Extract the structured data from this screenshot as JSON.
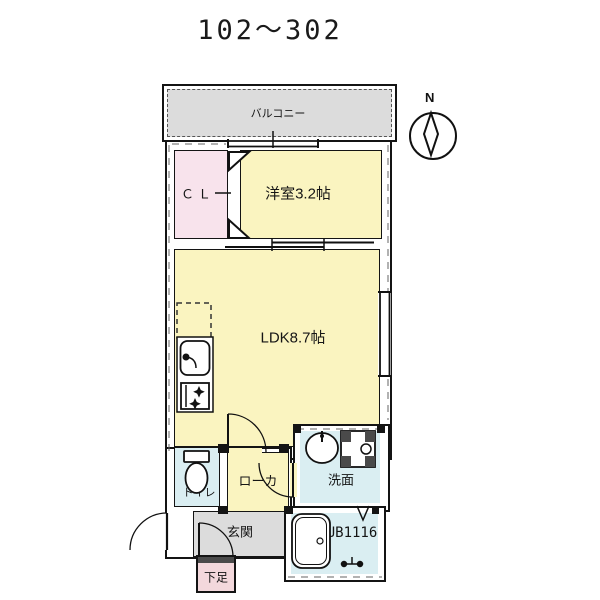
{
  "title": "102〜302",
  "compass": {
    "label": "N"
  },
  "rooms": {
    "balcony": {
      "label": "バルコニー"
    },
    "closet": {
      "label": "ＣＬ"
    },
    "bedroom": {
      "label": "洋室3.2帖"
    },
    "ldk": {
      "label": "LDK8.7帖"
    },
    "toilet": {
      "label": "トイレ"
    },
    "hallway": {
      "label": "ローカ"
    },
    "washroom": {
      "label": "洗面"
    },
    "entrance": {
      "label": "玄関"
    },
    "shoe_storage": {
      "label": "下足"
    },
    "bath": {
      "label": "UB1116"
    }
  },
  "colors": {
    "room_yellow": "#faf4c0",
    "closet_pink": "#f8e3ec",
    "shoe_pink": "#f3d8dc",
    "wet_blue": "#daeef2",
    "balcony_gray": "#dcdcdc",
    "wall_black": "#141414"
  }
}
